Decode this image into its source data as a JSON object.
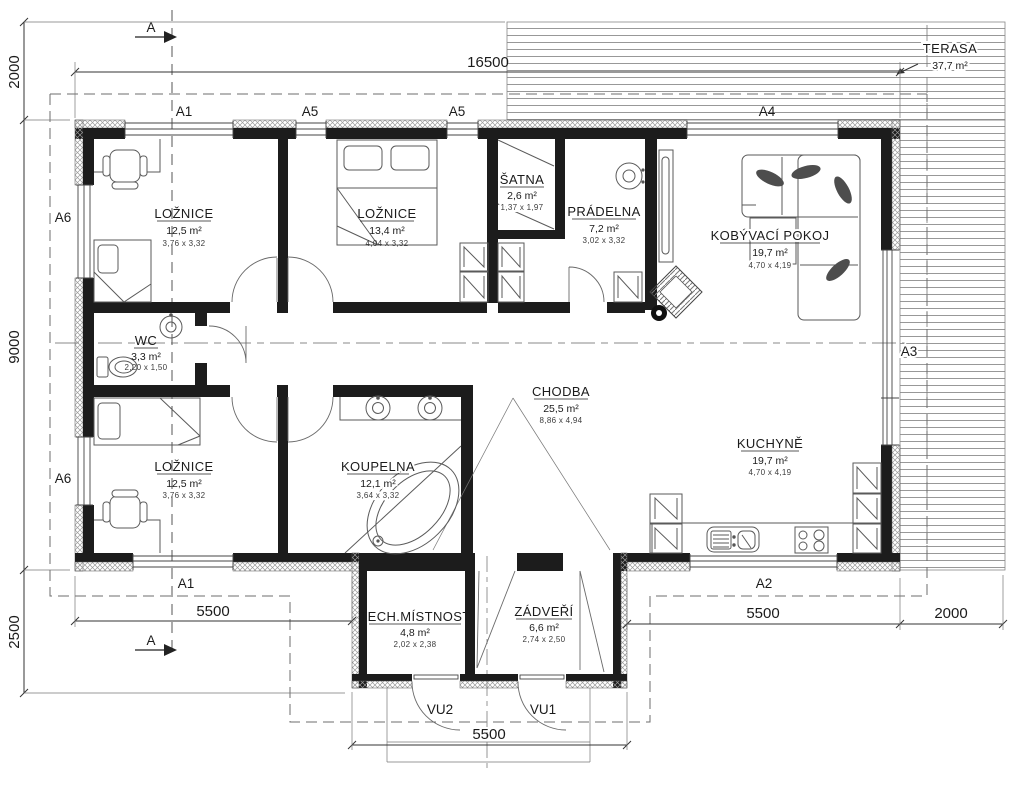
{
  "drawing_type": "floor-plan",
  "rooms": [
    {
      "name": "LOŽNICE",
      "area": "12,5 m²",
      "dims": "3,76 x 3,32"
    },
    {
      "name": "LOŽNICE",
      "area": "13,4 m²",
      "dims": "4,04 x 3,32"
    },
    {
      "name": "ŠATNA",
      "area": "2,6 m²",
      "dims": "1,37 x 1,97"
    },
    {
      "name": "PRÁDELNA",
      "area": "7,2 m²",
      "dims": "3,02 x 3,32"
    },
    {
      "name": "KOBÝVACÍ POKOJ",
      "area": "19,7 m²",
      "dims": "4,70 x 4,19"
    },
    {
      "name": "WC",
      "area": "3,3 m²",
      "dims": "2,20 x 1,50"
    },
    {
      "name": "CHODBA",
      "area": "25,5 m²",
      "dims": "8,86 x 4,94"
    },
    {
      "name": "KUCHYNĚ",
      "area": "19,7 m²",
      "dims": "4,70 x 4,19"
    },
    {
      "name": "LOŽNICE",
      "area": "12,5 m²",
      "dims": "3,76 x 3,32"
    },
    {
      "name": "KOUPELNA",
      "area": "12,1 m²",
      "dims": "3,64 x 3,32"
    },
    {
      "name": "TECH.MÍSTNOST",
      "area": "4,8 m²",
      "dims": "2,02 x 2,38"
    },
    {
      "name": "ZÁDVEŘÍ",
      "area": "6,6 m²",
      "dims": "2,74 x 2,50"
    }
  ],
  "terrace": {
    "name": "TERASA",
    "area": "37,7 m²"
  },
  "wall_markers": [
    {
      "label": "A1"
    },
    {
      "label": "A5"
    },
    {
      "label": "A5"
    },
    {
      "label": "A4"
    },
    {
      "label": "A6"
    },
    {
      "label": "A6"
    },
    {
      "label": "A3"
    },
    {
      "label": "A1"
    },
    {
      "label": "A2"
    }
  ],
  "door_markers": [
    {
      "label": "VU2"
    },
    {
      "label": "VU1"
    }
  ],
  "section": {
    "label": "A"
  },
  "dimensions": {
    "total_width": "16500",
    "terrace_depth": "2000",
    "house_depth": "9000",
    "porch_depth": "2500",
    "bottom_left": "5500",
    "bottom_right": "5500",
    "terrace_width": "2000",
    "porch_width": "5500"
  },
  "colors": {
    "wall": "#1c1c1c",
    "line": "#3a3a3a",
    "hatch": "#9a9a9a",
    "deck": "#8c8c8c",
    "background": "#ffffff"
  }
}
